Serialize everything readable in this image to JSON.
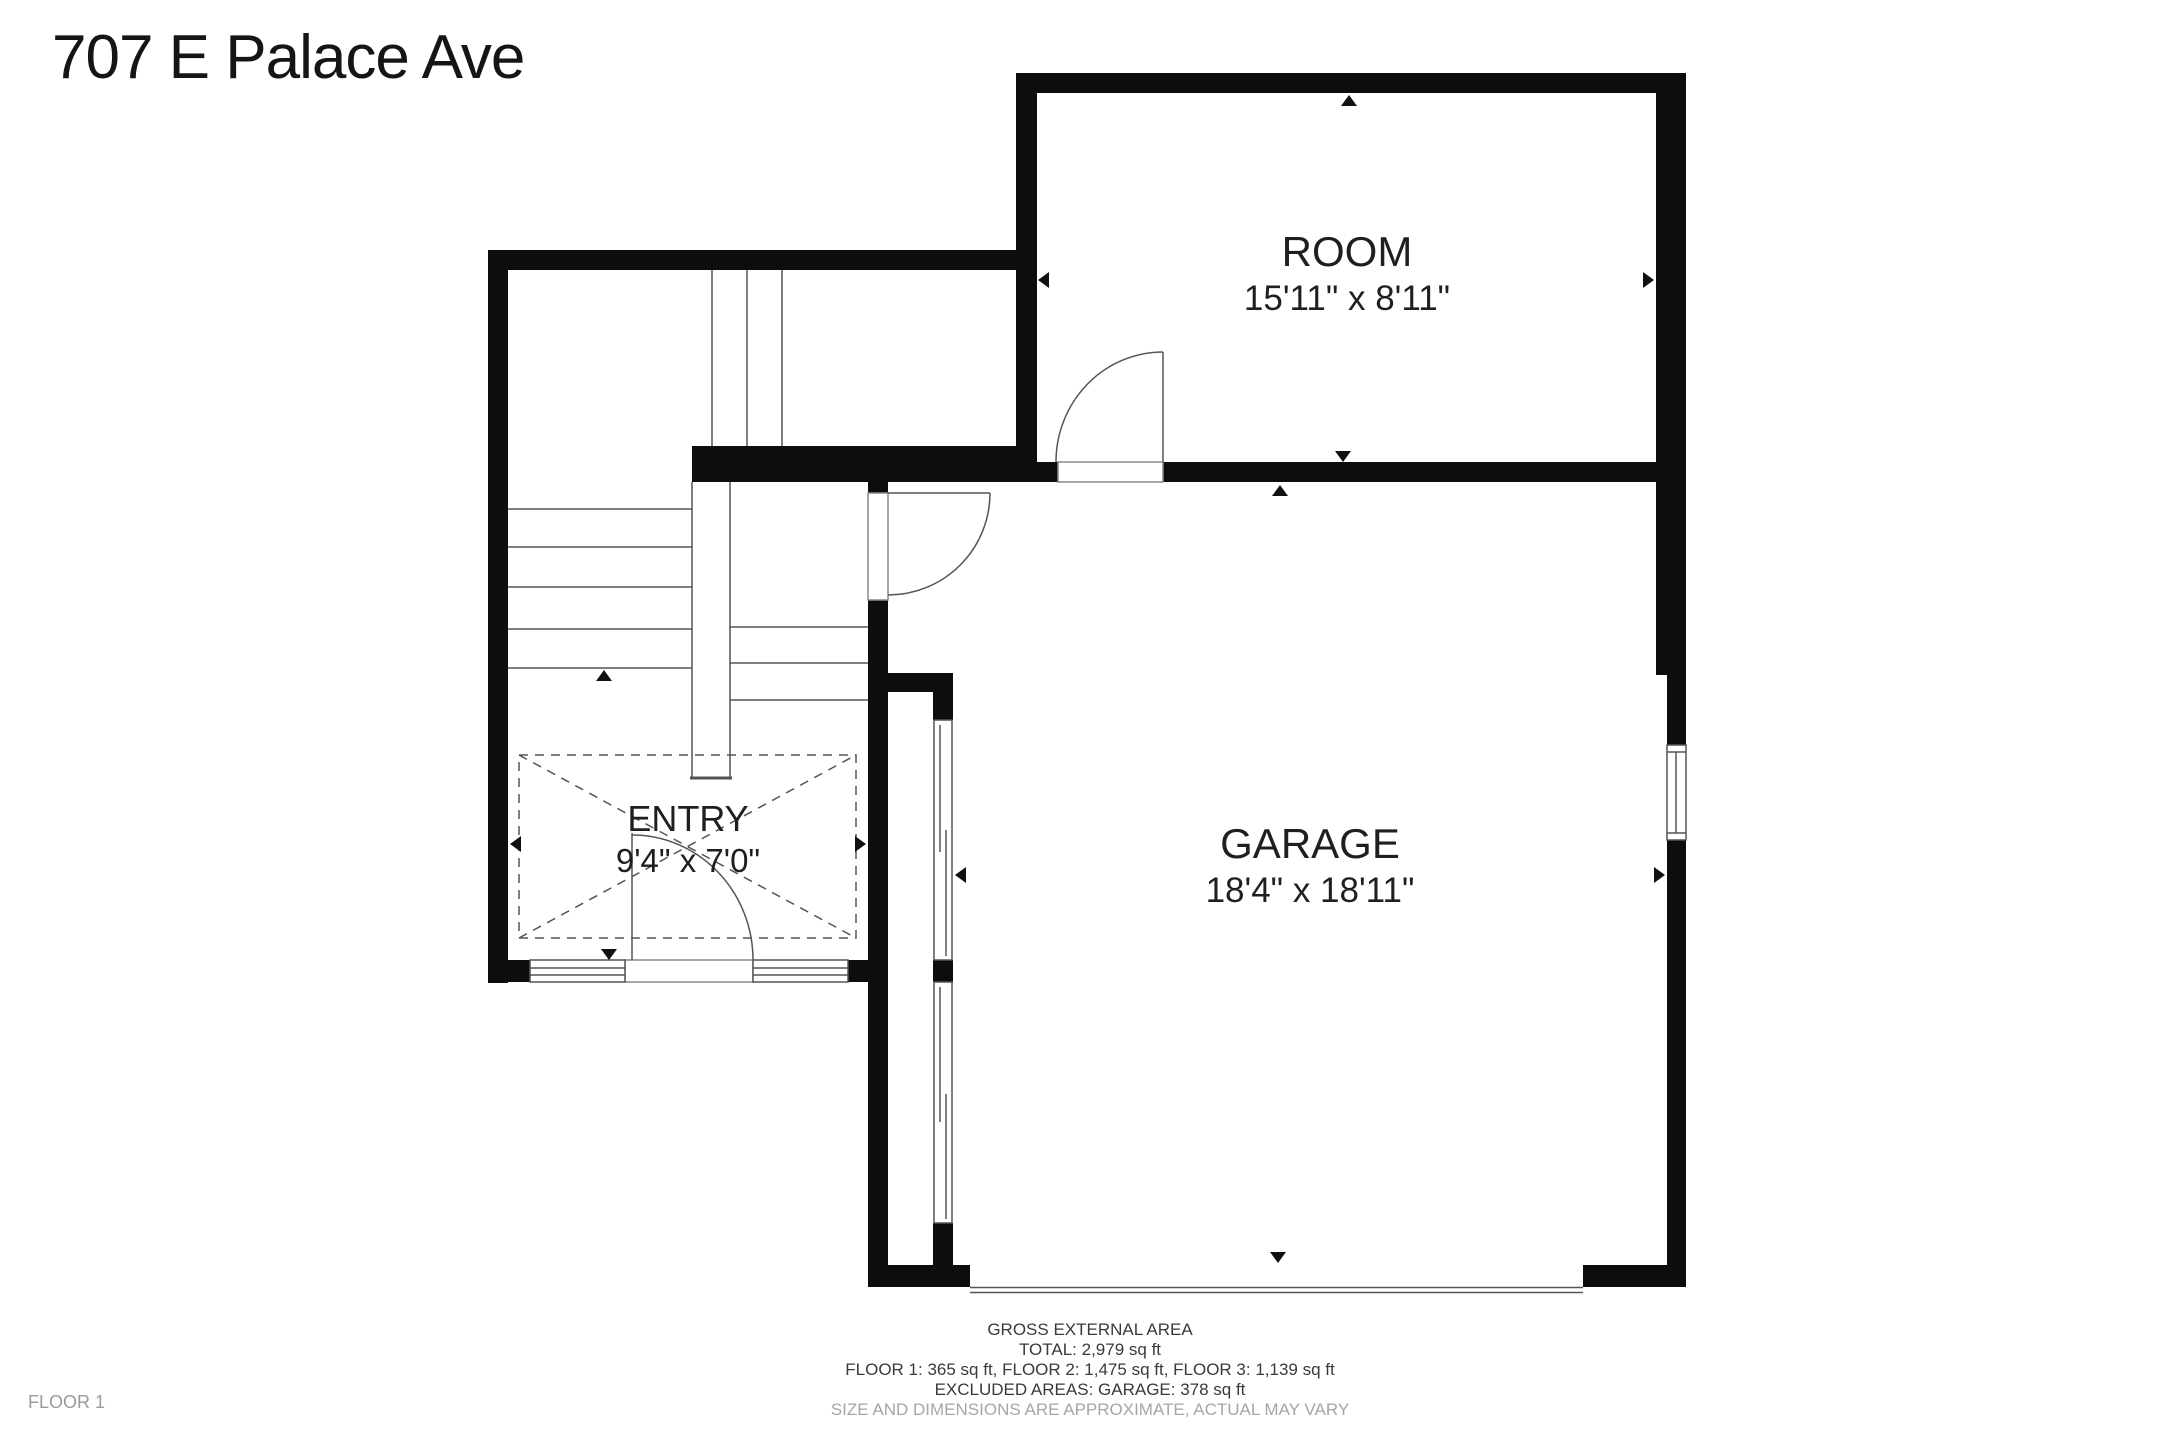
{
  "page": {
    "title": "707 E Palace Ave",
    "floor_label": "FLOOR 1"
  },
  "rooms": {
    "room": {
      "name": "ROOM",
      "dimensions": "15'11\" x 8'11\""
    },
    "garage": {
      "name": "GARAGE",
      "dimensions": "18'4\" x 18'11\""
    },
    "entry": {
      "name": "ENTRY",
      "dimensions": "9'4\" x 7'0\""
    }
  },
  "footer": {
    "line1": "GROSS EXTERNAL AREA",
    "line2": "TOTAL: 2,979 sq ft",
    "line3": "FLOOR 1: 365 sq ft, FLOOR 2: 1,475 sq ft, FLOOR 3: 1,139 sq ft",
    "line4": "EXCLUDED AREAS: GARAGE: 378 sq ft",
    "line5": "SIZE AND DIMENSIONS ARE APPROXIMATE, ACTUAL MAY VARY"
  },
  "colors": {
    "wall": "#0d0d0d",
    "thin_line": "#555555",
    "text": "#1f1f1f",
    "muted_text": "#9b9b9b"
  }
}
